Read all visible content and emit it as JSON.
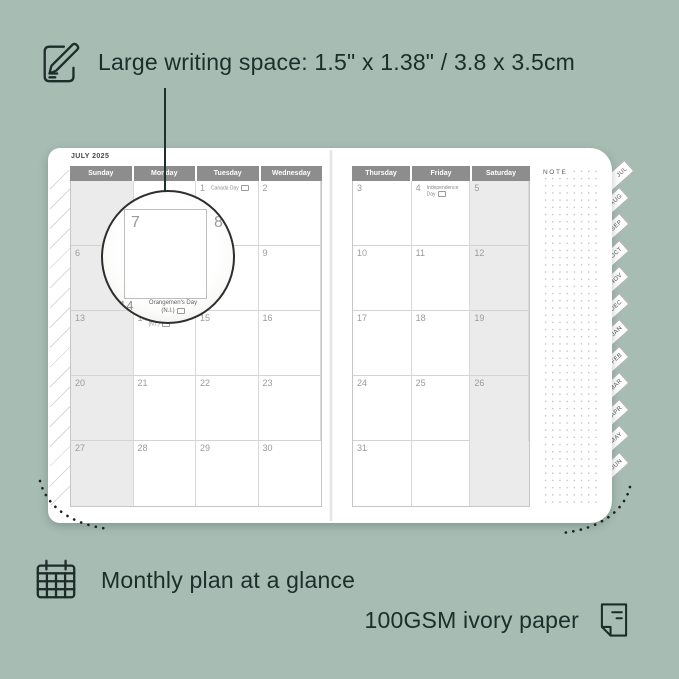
{
  "colors": {
    "background": "#a7bcb3",
    "ink": "#1d2d2a",
    "header_bg": "#8d8d8d",
    "shaded_column": "#ebebeb",
    "page": "#ffffff"
  },
  "annotations": {
    "top": {
      "icon": "pencil-note-icon",
      "text": "Large writing space: 1.5\" x 1.38\" / 3.8 x 3.5cm"
    },
    "bottom_left": {
      "icon": "calendar-grid-icon",
      "text": "Monthly plan at a glance"
    },
    "bottom_right": {
      "icon": "paper-sheet-icon",
      "text": "100GSM ivory paper"
    }
  },
  "planner": {
    "title": "JULY 2025",
    "note_label": "NOTE",
    "left_page": {
      "shaded_col": 0,
      "headers": [
        "Sunday",
        "Monday",
        "Tuesday",
        "Wednesday"
      ],
      "rows": [
        [
          {
            "d": ""
          },
          {
            "d": ""
          },
          {
            "d": "1",
            "h": "Canada Day"
          },
          {
            "d": "2"
          }
        ],
        [
          {
            "d": "6"
          },
          {
            "d": "7"
          },
          {
            "d": "8"
          },
          {
            "d": "9"
          }
        ],
        [
          {
            "d": "13"
          },
          {
            "d": "14",
            "h": "Orangemen's Day (N.I.)"
          },
          {
            "d": "15"
          },
          {
            "d": "16"
          }
        ],
        [
          {
            "d": "20"
          },
          {
            "d": "21"
          },
          {
            "d": "22"
          },
          {
            "d": "23"
          }
        ],
        [
          {
            "d": "27"
          },
          {
            "d": "28"
          },
          {
            "d": "29"
          },
          {
            "d": "30"
          }
        ]
      ]
    },
    "right_page": {
      "shaded_col": 2,
      "headers": [
        "Thursday",
        "Friday",
        "Saturday"
      ],
      "rows": [
        [
          {
            "d": "3"
          },
          {
            "d": "4",
            "h": "Independence Day"
          },
          {
            "d": "5"
          }
        ],
        [
          {
            "d": "10"
          },
          {
            "d": "11"
          },
          {
            "d": "12"
          }
        ],
        [
          {
            "d": "17"
          },
          {
            "d": "18"
          },
          {
            "d": "19"
          }
        ],
        [
          {
            "d": "24"
          },
          {
            "d": "25"
          },
          {
            "d": "26"
          }
        ],
        [
          {
            "d": "31"
          },
          {
            "d": ""
          },
          {
            "d": ""
          }
        ]
      ]
    },
    "magnifier": {
      "big_day": "7",
      "next_day": "8",
      "bottom_day": "14",
      "bottom_holiday": "Orangemen's Day",
      "bottom_holiday_region": "(N.I.)"
    },
    "tabs": [
      "JUL",
      "AUG",
      "SEP",
      "OCT",
      "NOV",
      "DEC",
      "JAN",
      "FEB",
      "MAR",
      "APR",
      "MAY",
      "JUN"
    ]
  }
}
